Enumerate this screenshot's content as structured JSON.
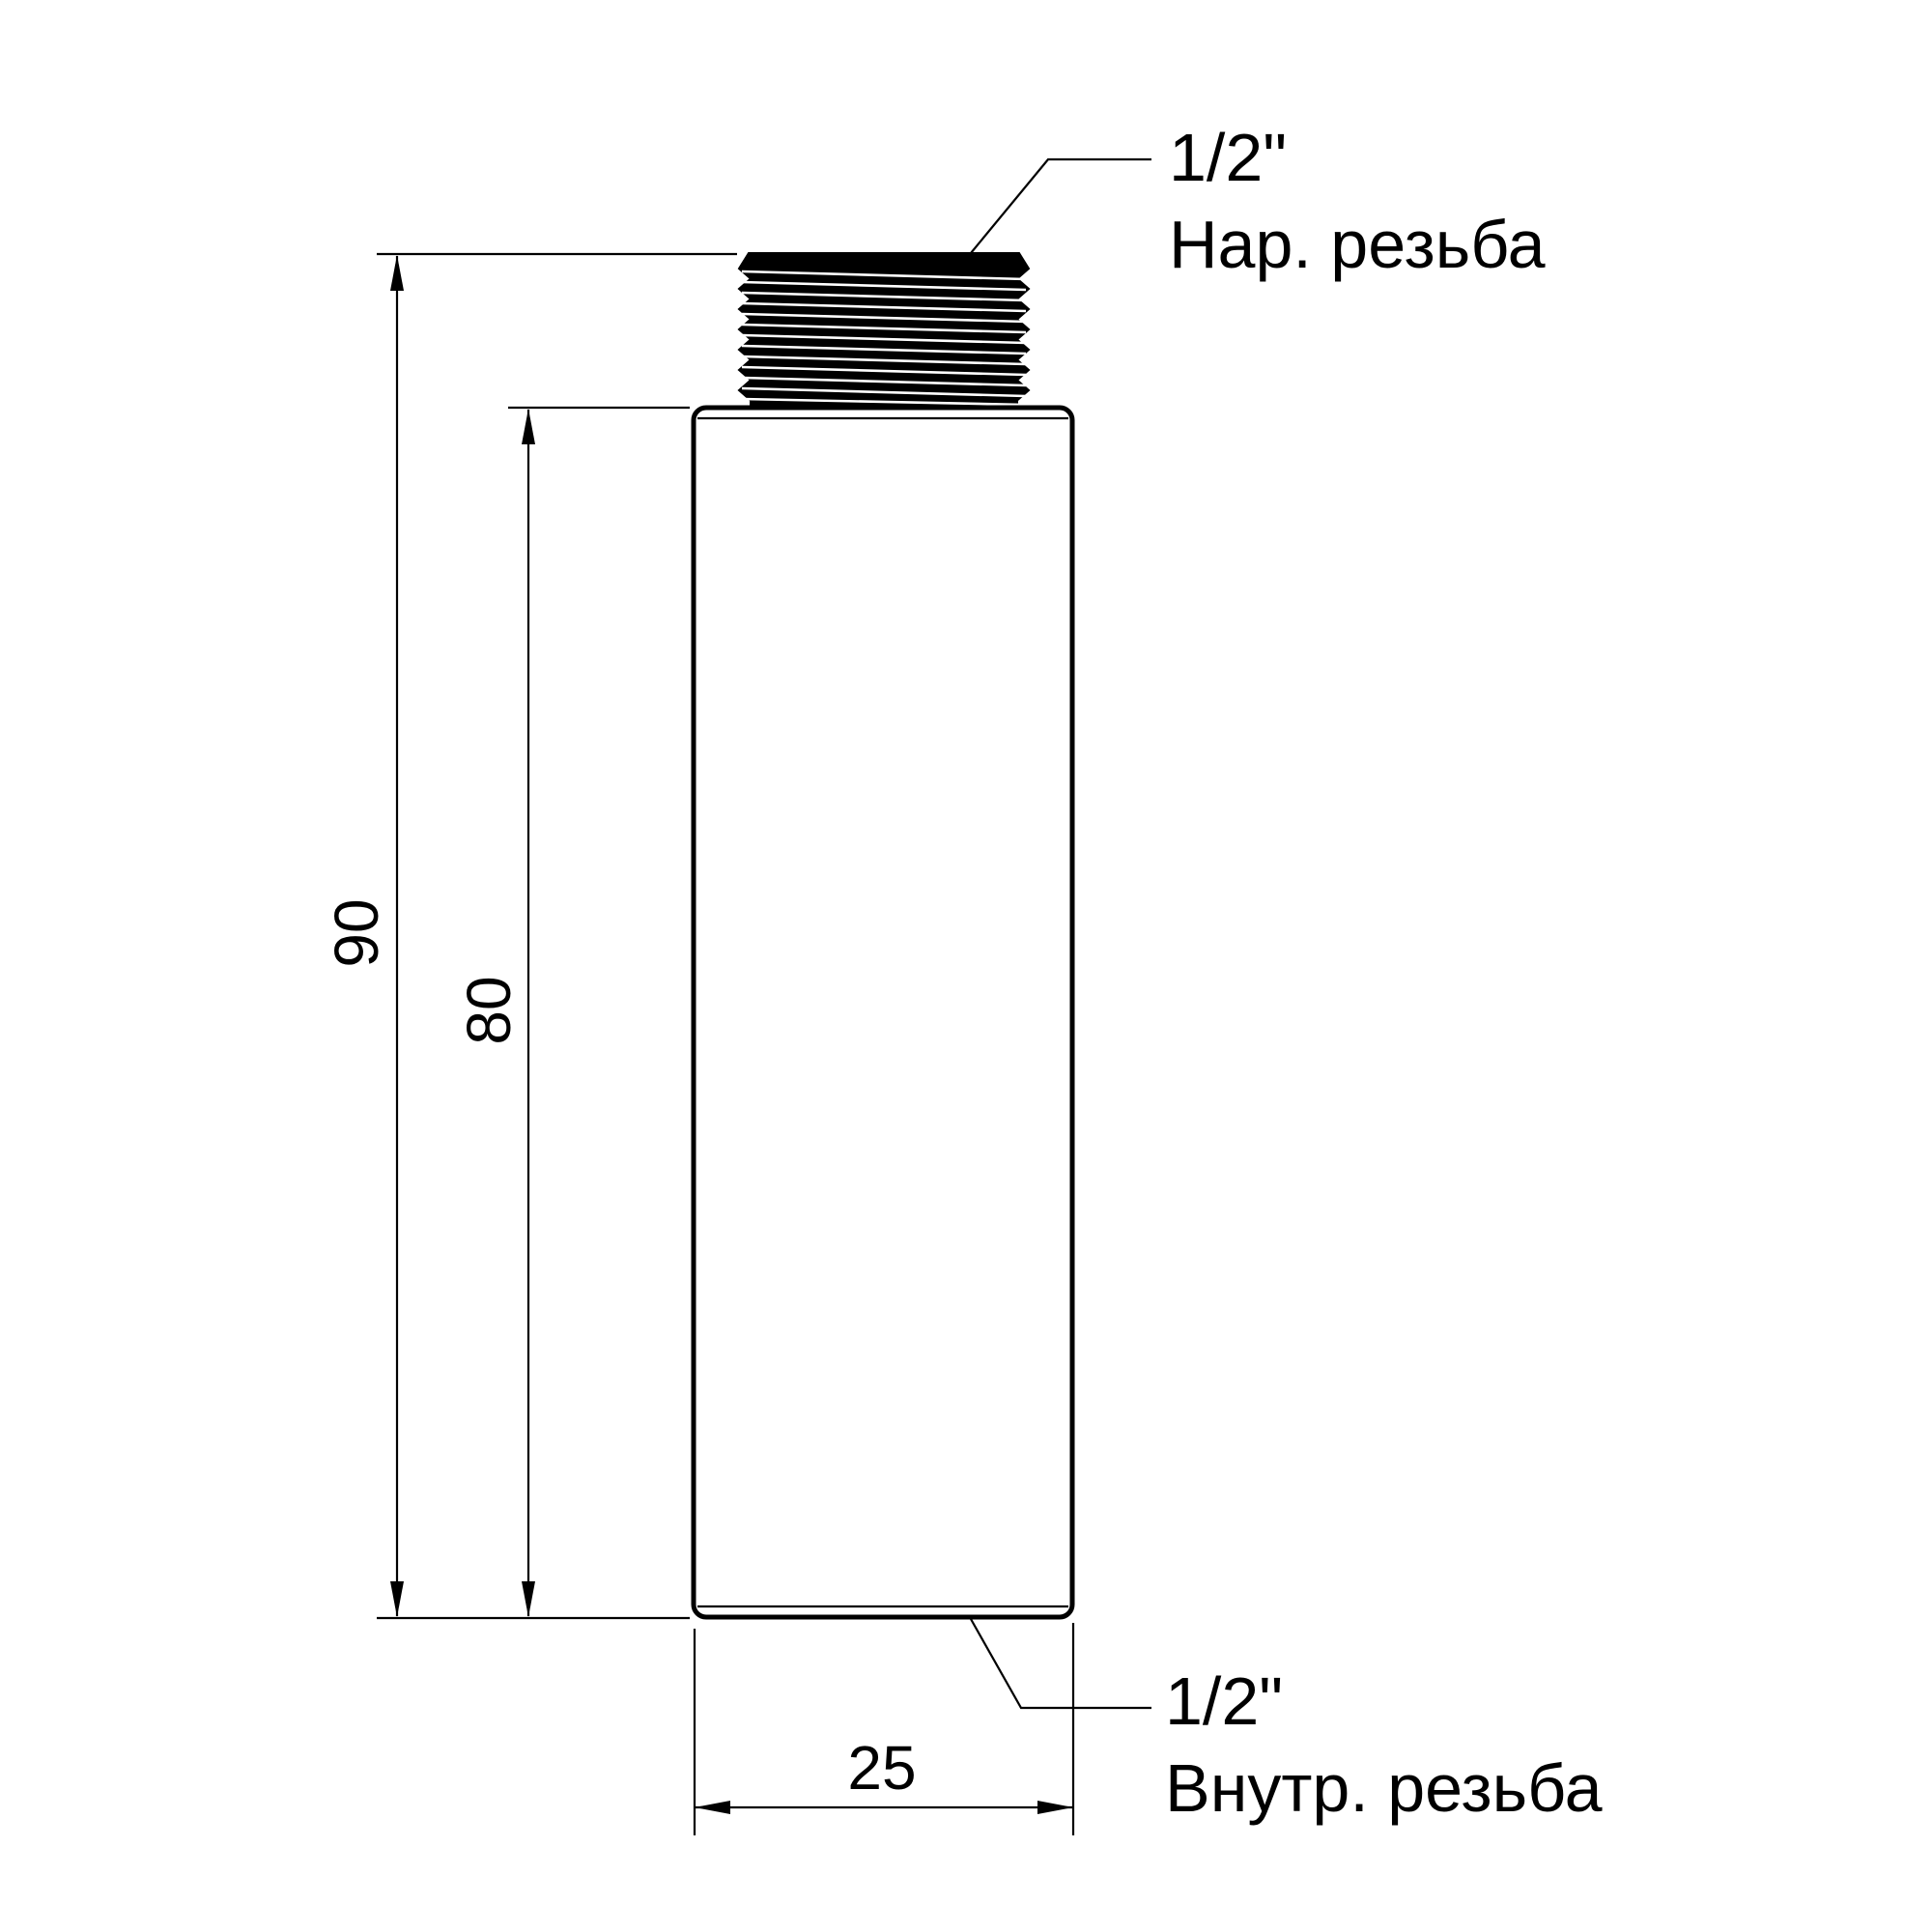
{
  "drawing": {
    "dim_total_height": "90",
    "dim_body_height": "80",
    "dim_body_width": "25",
    "top_thread": {
      "size": "1/2\"",
      "label": "Нар. резьба"
    },
    "bottom_thread": {
      "size": "1/2\"",
      "label": "Внутр. резьба"
    },
    "colors": {
      "line": "#000000",
      "background": "#ffffff"
    }
  }
}
